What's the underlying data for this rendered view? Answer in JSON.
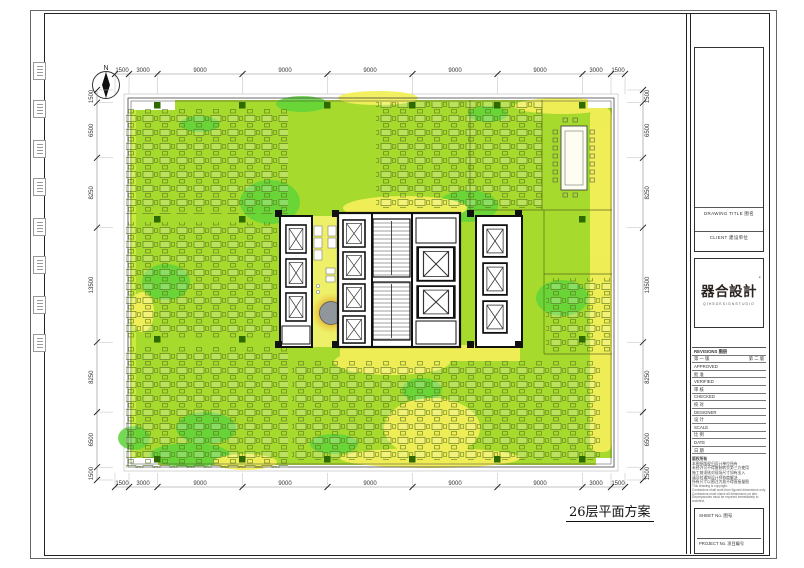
{
  "drawing": {
    "title": "26层平面方案",
    "north_label": "N",
    "dims_top": [
      "1500",
      "3000",
      "9000",
      "9000",
      "9000",
      "9000",
      "9000",
      "3000",
      "1500"
    ],
    "dims_bottom": [
      "1500",
      "3000",
      "9000",
      "9000",
      "9000",
      "9000",
      "9000",
      "3000",
      "1500"
    ],
    "dims_left": [
      "1500",
      "6500",
      "8250",
      "13500",
      "8250",
      "6500",
      "1500"
    ],
    "dims_right": [
      "1500",
      "6500",
      "8250",
      "13500",
      "8250",
      "6500",
      "1500"
    ],
    "colors": {
      "field_green": "#a6da2d",
      "bright_green": "#5ed33a",
      "yellow": "#f2ef58",
      "column_green": "#2f6a00",
      "orange_glow": "#dd8f2f",
      "core_wall": "#111111"
    }
  },
  "title_block": {
    "drawing_title_label": "DRAWING TITLE  图名",
    "client_label": "CLIENT  建设单位",
    "logo": "器合設計",
    "logo_mark": "'",
    "logo_sub": "QIHEDESIGNSTUDIO",
    "revisions_header": "REVISIONS  图册",
    "revision_left": "第 一 版",
    "revision_right": "第 二 版",
    "rows": [
      {
        "en": "APPROVED",
        "cn": "批 准"
      },
      {
        "en": "VERIFIED",
        "cn": "审 核"
      },
      {
        "en": "CHECKED",
        "cn": "校 对"
      },
      {
        "en": "DESIGNER",
        "cn": "设 计"
      },
      {
        "en": "SCALE",
        "cn": "比 例"
      },
      {
        "en": "DATE",
        "cn": "日 期"
      }
    ],
    "notes": [
      "版权所有",
      "本图纸版权归设计单位所有",
      "未经许可不得复制转交第三方使用",
      "施工前须核对现场尺寸如有出入",
      "请及时通知设计师协商解决",
      "所有尺寸以图注为准不得直接量图",
      "This drawing is copyright.",
      "Contractors shall work from figured dimensions only.",
      "Contractors must check all dimensions on site.",
      "Discrepancies must be reported immediately to architect."
    ],
    "sheet_no_label": "SHEET No.  图号",
    "project_no_label": "PROJECT No.  项目编号"
  }
}
